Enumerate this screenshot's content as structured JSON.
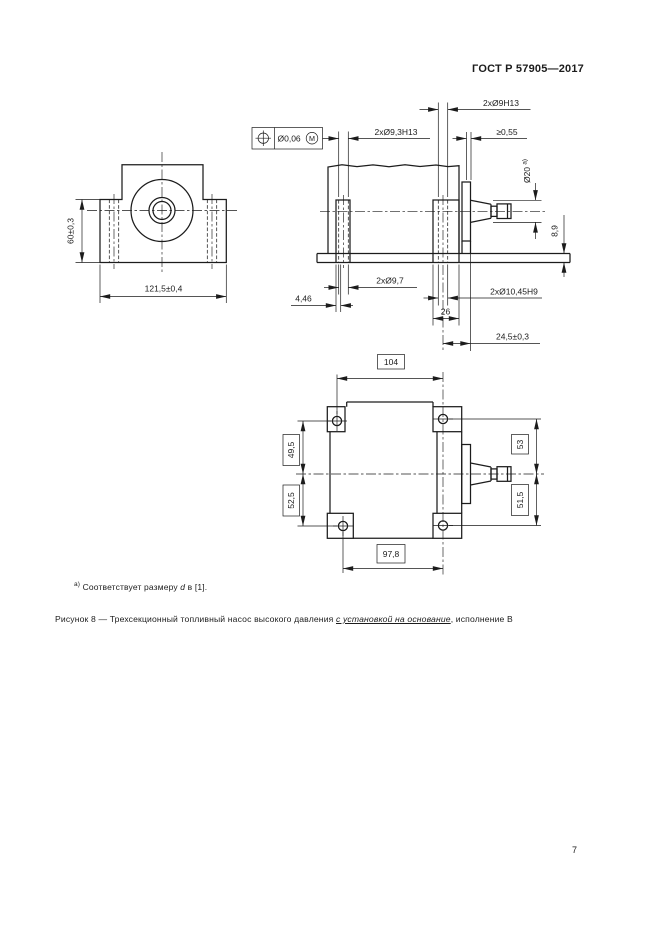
{
  "page": {
    "header": "ГОСТ Р 57905—2017",
    "page_number": "7"
  },
  "footnote": {
    "marker": "а)",
    "text_before_d": " Соответствует размеру ",
    "d": "d",
    "text_after_d": " в [1]."
  },
  "caption": {
    "part1": "Рисунок 8 — Трехсекционный топливный насос высокого давления ",
    "underlined": "с установкой на основание",
    "part3": ", исполнение В"
  },
  "front_view": {
    "dim_height": "60±0,3",
    "dim_width": "121,5±0,4"
  },
  "side_view": {
    "gdt_value": "Ø0,06",
    "gdt_modifier": "M",
    "dim_holes_right_top": "2xØ9H13",
    "dim_holes_left_top": "2xØ9,3H13",
    "dim_min_gap": "≥0,55",
    "dim_shaft_diameter": "Ø20",
    "dim_shaft_diameter_note": "а)",
    "dim_plate_thickness": "8,9",
    "dim_holes_left_bottom": "2xØ9,7",
    "dim_edge_offset": "4,46",
    "dim_holes_right_bottom": "2xØ10,45H9",
    "dim_foot_width": "26",
    "dim_shaft_to_hole": "24,5±0,3"
  },
  "top_view": {
    "dim_hole_span_top": "104",
    "dim_upper_left": "49,5",
    "dim_lower_left": "52,5",
    "dim_upper_right": "53",
    "dim_lower_right": "51,5",
    "dim_hole_span_bottom": "97,8"
  }
}
